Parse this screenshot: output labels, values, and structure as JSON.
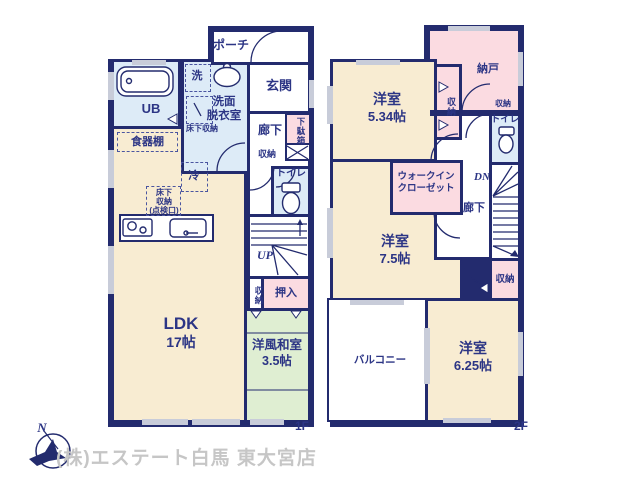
{
  "colors": {
    "wall": "#232b6e",
    "ink": "#2c3585",
    "cream": "#f8ecd2",
    "pink": "#fbdbe1",
    "blue": "#ddebf7",
    "green": "#dfeed2",
    "win": "#c8ccd9",
    "gray": "#c6c6c6"
  },
  "floor1": {
    "floor_tag": "1F",
    "rooms": {
      "porch": {
        "label": "ポーチ"
      },
      "entrance": {
        "label": "玄関"
      },
      "washroom": {
        "line1": "洗面",
        "line2": "脱衣室"
      },
      "washer": {
        "label": "洗"
      },
      "ub": {
        "label": "UB"
      },
      "underfloor_washroom": {
        "label": "床下収納"
      },
      "cupboard": {
        "label": "食器棚"
      },
      "fridge": {
        "label": "冷"
      },
      "underfloor_kitchen": {
        "line1": "床下",
        "line2": "収納",
        "line3": "(点検口)"
      },
      "hallway": {
        "label": "廊下"
      },
      "shoe_cabinet": {
        "label": "下駄箱"
      },
      "hall_storage": {
        "label": "収納"
      },
      "toilet": {
        "label": "トイレ"
      },
      "stairs": {
        "label": "UP"
      },
      "stair_storage": {
        "label": "収納"
      },
      "oshiire": {
        "label": "押入"
      },
      "ldk": {
        "label": "LDK",
        "size": "17帖"
      },
      "washitsu": {
        "label": "洋風和室",
        "size": "3.5帖"
      }
    }
  },
  "floor2": {
    "floor_tag": "2F",
    "rooms": {
      "nando": {
        "label": "納戸"
      },
      "bedroom1": {
        "label": "洋室",
        "size": "5.34帖"
      },
      "closet1": {
        "label": "収納"
      },
      "shelf_storage": {
        "label": "収納"
      },
      "toilet": {
        "label": "トイレ"
      },
      "stairs": {
        "label": "DN"
      },
      "wic": {
        "line1": "ウォークイン",
        "line2": "クローゼット"
      },
      "hallway": {
        "label": "廊下"
      },
      "bedroom2": {
        "label": "洋室",
        "size": "7.5帖"
      },
      "closet2": {
        "label": "収納"
      },
      "balcony": {
        "label": "バルコニー"
      },
      "bedroom3": {
        "label": "洋室",
        "size": "6.25帖"
      }
    }
  },
  "footer": {
    "company": "(株)エステート白馬 東大宮店",
    "compass_north": "N"
  }
}
